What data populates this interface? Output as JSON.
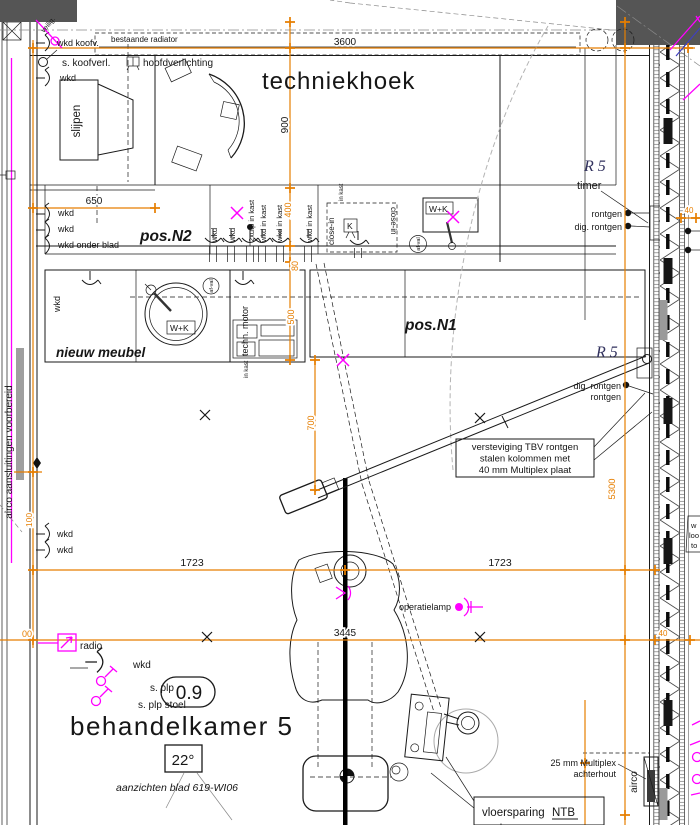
{
  "colors": {
    "dimension_orange": "#e67e00",
    "electrical_magenta": "#ff00ff",
    "note_blue": "#32325e",
    "wall_dark": "#555555"
  },
  "room": {
    "number": "0.9",
    "name": "behandelkamer 5",
    "temperature": "22°",
    "sheet_note": "aanzichten blad 619-WI06",
    "corner_area": "techniekhoek"
  },
  "positions": {
    "pos_n1": "pos.N1",
    "pos_n2": "pos.N2",
    "nieuw_meubel": "nieuw meubel",
    "slijpen": "slijpen"
  },
  "dims": {
    "top_3600": "3600",
    "corner_900": "900",
    "counter_650": "650",
    "kast_400": "400",
    "front_80": "80",
    "depth_500": "500",
    "xray_700": "700",
    "left_1723": "1723",
    "right_1723": "1723",
    "chair_3445": "3445",
    "wall_5300": "5300",
    "small_100": "100",
    "small_00": "00",
    "cavity_40_top": "40",
    "cavity_40_bottom": "40"
  },
  "labels": {
    "veilig": "veilig.",
    "wkd_koofv": "wkd koofv.",
    "bestaande_radiator": "bestaande radiator",
    "s_koofverl": "s. koofverl.",
    "hoofdverlichting": "hoofdverlichting",
    "wkd_top": "wkd",
    "wkd_650_1": "wkd",
    "wkd_650_2": "wkd",
    "wkd_onder_blad": "wkd onder blad",
    "rot_wkd_1": "wkd",
    "rot_wkd_2": "wkd",
    "rot_2xutp": "2xutp in kast",
    "rot_wkd_kast_1": "wkd in kast",
    "rot_wkd_kast_2": "wkd in kast",
    "rot_wkd_kast_3": "wkd in kast",
    "close_in": "close-in",
    "close_in_kast": "in kast",
    "close_in_rev": "close-in",
    "k_unit": "K",
    "wk_unit_top": "W+K",
    "wk_unit_sink": "W+K",
    "afval_top": "af-val",
    "afval_sink": "af-val",
    "techn_motor": "techn. motor",
    "techn_motor_kast": "in kast",
    "wkd_sink": "wkd",
    "r5_timer": "R 5",
    "timer": "timer",
    "rontgen_1": "rontgen",
    "dig_rontgen_1": "dig. rontgen",
    "r5_xray": "R 5",
    "dig_rontgen_2": "dig. rontgen",
    "rontgen_2": "rontgen",
    "versteviging_1": "versteviging TBV rontgen",
    "versteviging_2": "stalen kolommen met",
    "versteviging_3": "40 mm Multiplex plaat",
    "operatielamp": "operatielamp",
    "wkd_mid_1": "wkd",
    "wkd_mid_2": "wkd",
    "radio": "radio",
    "wkd_bottom": "wkd",
    "s_plp": "s. plp",
    "s_plp_stoel": "s. plp stoel",
    "multiplex_1": "25 mm Multiplex",
    "multiplex_2": "achterhout",
    "airco_wall": "airco",
    "vloersparing": "vloersparing",
    "ntb": "NTB",
    "vloersparing_sub": "verb",
    "airco_prep": "airco aansluitingen voorbereid",
    "edge_1": "w",
    "edge_2": "loo",
    "edge_3": "to"
  }
}
